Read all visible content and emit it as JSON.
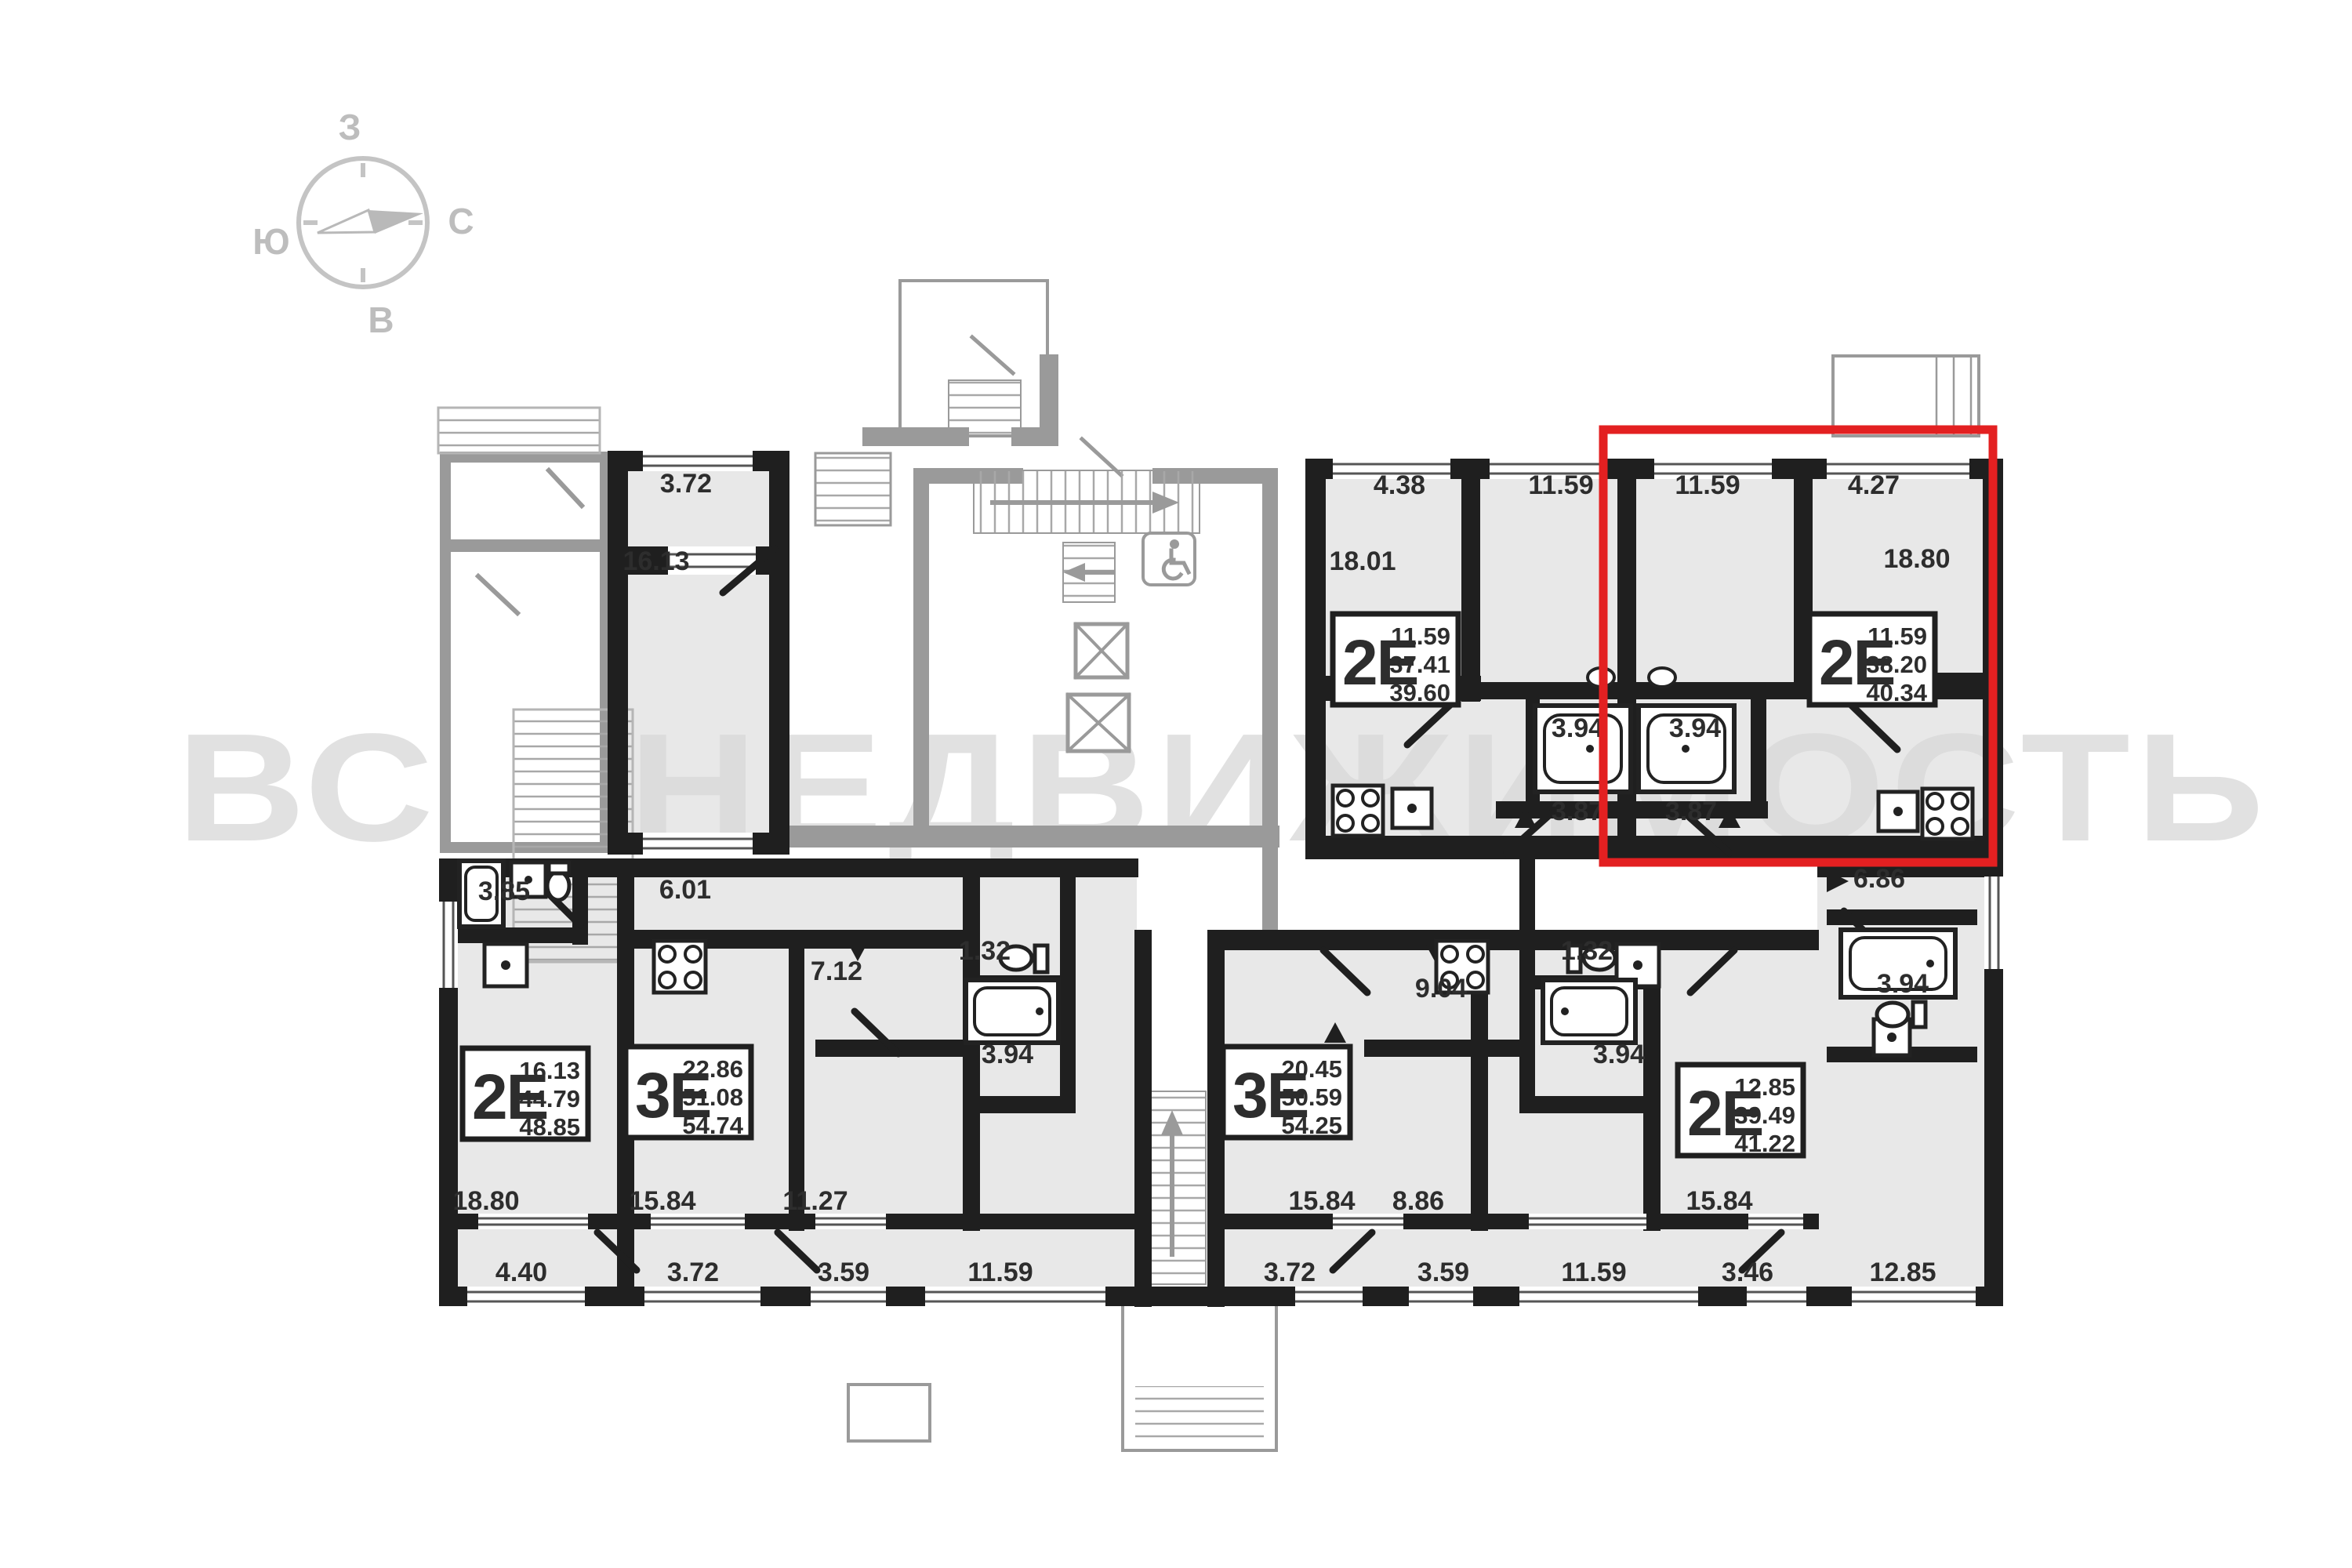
{
  "watermark": {
    "text": "ВСЯ НЕДВИЖИМОСТЬ"
  },
  "compass": {
    "top": "З",
    "right": "С",
    "left": "Ю",
    "bottom": "В"
  },
  "colors": {
    "highlight": "#e32021",
    "wall": "#1f1f1f",
    "room_fill": "#e8e8e8",
    "common_gray": "#9a9a9a",
    "watermark_gray": "#dadada"
  },
  "apartments": [
    {
      "type": "2Е",
      "room": "11.59",
      "living": "37.41",
      "total": "39.60"
    },
    {
      "type": "2Е",
      "room": "11.59",
      "living": "38.20",
      "total": "40.34",
      "highlighted": true
    },
    {
      "type": "2Е",
      "room": "16.13",
      "living": "44.79",
      "total": "48.85"
    },
    {
      "type": "3Е",
      "room": "22.86",
      "living": "51.08",
      "total": "54.74"
    },
    {
      "type": "3Е",
      "room": "20.45",
      "living": "50.59",
      "total": "54.25"
    },
    {
      "type": "2Е",
      "room": "12.85",
      "living": "39.49",
      "total": "41.22"
    }
  ],
  "rooms": {
    "a1": "3.72",
    "a2": "16.13",
    "b1": "4.38",
    "b2": "11.59",
    "b3": "18.01",
    "b4": "3.94",
    "b5": "3.87",
    "c1": "11.59",
    "c2": "4.27",
    "c3": "18.80",
    "c4": "3.94",
    "c5": "3.87",
    "d1": "3.85",
    "d2": "18.80",
    "d3": "4.40",
    "e1": "6.01",
    "e2": "7.12",
    "e3": "1.32",
    "e4": "3.94",
    "e5": "15.84",
    "e6": "11.27",
    "e7": "3.72",
    "e8": "3.59",
    "e9": "11.59",
    "f1": "9.04",
    "f2": "1.32",
    "f3": "3.94",
    "f4": "15.84",
    "f5": "8.86",
    "f6": "3.72",
    "f7": "3.59",
    "f8": "11.59",
    "g1": "6.86",
    "g2": "3.94",
    "g3": "15.84",
    "g4": "3.46",
    "g5": "12.85"
  }
}
